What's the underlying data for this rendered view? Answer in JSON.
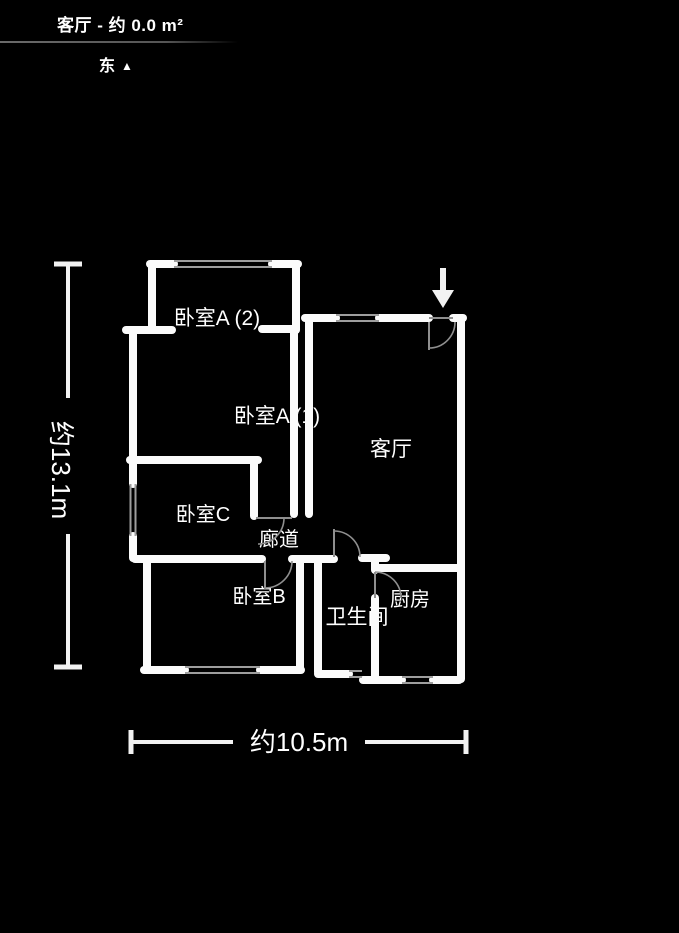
{
  "header": {
    "title": "客厅 - 约 0.0 m²",
    "compass": {
      "label": "东",
      "symbol": "▲"
    }
  },
  "floorplan": {
    "rooms": [
      {
        "id": "bedroom-a2",
        "label": "卧室A (2)",
        "x": 217,
        "y": 325,
        "size": 21
      },
      {
        "id": "bedroom-a1",
        "label": "卧室A (1)",
        "x": 277,
        "y": 423,
        "size": 21
      },
      {
        "id": "living-room",
        "label": "客厅",
        "x": 391,
        "y": 456,
        "size": 21
      },
      {
        "id": "bedroom-c",
        "label": "卧室C",
        "x": 203,
        "y": 521,
        "size": 20
      },
      {
        "id": "corridor",
        "label": "廊道",
        "x": 279,
        "y": 546,
        "size": 20
      },
      {
        "id": "bedroom-b",
        "label": "卧室B",
        "x": 259,
        "y": 603,
        "size": 20
      },
      {
        "id": "bathroom",
        "label": "卫生间",
        "x": 357,
        "y": 624,
        "size": 21
      },
      {
        "id": "kitchen",
        "label": "厨房",
        "x": 410,
        "y": 606,
        "size": 20
      }
    ],
    "dimensions": {
      "height": {
        "label": "约13.1m",
        "x": 61,
        "y": 470,
        "rotate": 90
      },
      "width": {
        "label": "约10.5m",
        "x": 299,
        "y": 751,
        "rotate": 0
      }
    },
    "colors": {
      "background": "#000000",
      "wall": "#fbfbfb",
      "window_line": "#9e9e9e",
      "door_line": "#8f8f8f",
      "text": "#ffffff",
      "dimension": "#f2f2f2"
    },
    "geometry": {
      "wall_thickness": 8,
      "walls": [
        [
          152,
          264,
          152,
          330
        ],
        [
          296,
          264,
          296,
          330
        ],
        [
          294,
          330,
          294,
          514
        ],
        [
          309,
          322,
          309,
          514
        ],
        [
          133,
          330,
          133,
          460
        ],
        [
          133,
          460,
          133,
          484
        ],
        [
          133,
          536,
          133,
          558
        ],
        [
          254,
          462,
          254,
          516
        ],
        [
          147,
          563,
          147,
          668
        ],
        [
          300,
          561,
          300,
          668
        ],
        [
          318,
          561,
          318,
          672
        ],
        [
          375,
          560,
          375,
          570
        ],
        [
          375,
          598,
          375,
          676
        ],
        [
          461,
          320,
          461,
          679
        ],
        [
          150,
          264,
          174,
          264
        ],
        [
          272,
          264,
          298,
          264
        ],
        [
          126,
          330,
          172,
          330
        ],
        [
          262,
          329,
          296,
          329
        ],
        [
          305,
          318,
          336,
          318
        ],
        [
          379,
          318,
          429,
          318
        ],
        [
          453,
          318,
          463,
          318
        ],
        [
          130,
          460,
          258,
          460
        ],
        [
          135,
          559,
          262,
          559
        ],
        [
          292,
          559,
          334,
          559
        ],
        [
          362,
          558,
          386,
          558
        ],
        [
          376,
          568,
          459,
          568
        ],
        [
          144,
          670,
          185,
          670
        ],
        [
          260,
          670,
          301,
          670
        ],
        [
          318,
          674,
          349,
          674
        ],
        [
          363,
          680,
          402,
          680
        ],
        [
          433,
          680,
          459,
          680
        ]
      ],
      "windows": [
        [
          174,
          261,
          272,
          261
        ],
        [
          174,
          267,
          272,
          267
        ],
        [
          336,
          315,
          379,
          315
        ],
        [
          336,
          321,
          379,
          321
        ],
        [
          130.5,
          484,
          130.5,
          536
        ],
        [
          135.5,
          484,
          135.5,
          536
        ],
        [
          185,
          667,
          260,
          667
        ],
        [
          185,
          673,
          260,
          673
        ],
        [
          349,
          671,
          362,
          671
        ],
        [
          349,
          677,
          362,
          677
        ],
        [
          402,
          677,
          433,
          677
        ],
        [
          402,
          683,
          433,
          683
        ]
      ],
      "door_lines": [
        [
          429,
          318,
          453,
          318
        ],
        [
          429,
          322,
          429,
          350
        ],
        [
          334,
          529,
          334,
          557
        ],
        [
          265,
          561,
          265,
          589
        ],
        [
          256,
          518,
          292,
          518
        ],
        [
          375,
          572,
          375,
          598
        ]
      ],
      "door_arcs": [
        "M455,322 A26,26 0 0 1 429,348",
        "M334,531 A26,26 0 0 1 360,557",
        "M292,561 A27,27 0 0 1 265,588",
        "M284,518 A26,26 0 0 1 258,544",
        "M375,572 A26,26 0 0 1 401,598"
      ],
      "entrance_arrow": {
        "stem": [
          443,
          268,
          443,
          292
        ],
        "head": "432,290 454,290 443,308"
      },
      "dim_vertical": {
        "caps": [
          [
            54,
            264,
            82,
            264
          ],
          [
            54,
            667,
            82,
            667
          ]
        ],
        "lines": [
          [
            68,
            266,
            68,
            398
          ],
          [
            68,
            534,
            68,
            665
          ]
        ]
      },
      "dim_horizontal": {
        "caps": [
          [
            131,
            730,
            131,
            754
          ],
          [
            466,
            730,
            466,
            754
          ]
        ],
        "lines": [
          [
            133,
            742,
            233,
            742
          ],
          [
            365,
            742,
            464,
            742
          ]
        ]
      }
    }
  }
}
